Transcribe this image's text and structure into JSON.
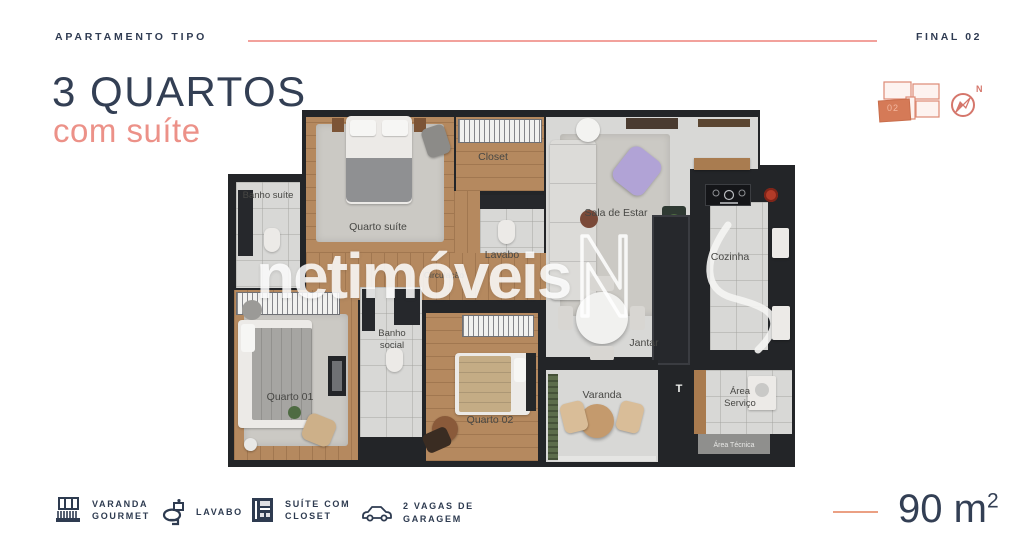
{
  "header": {
    "eyebrow": "APARTAMENTO TIPO",
    "final_label": "FINAL 02",
    "title": "3 QUARTOS",
    "subtitle": "com suíte"
  },
  "keyplan": {
    "unit_number": "02",
    "compass_label": "N"
  },
  "floorplan": {
    "rooms": {
      "banho_suite": "Banho suíte",
      "quarto_suite": "Quarto suíte",
      "closet": "Closet",
      "lavabo": "Lavabo",
      "circulacao": "Circulação",
      "sala_de_estar": "Sala de Estar",
      "cozinha": "Cozinha",
      "quarto_01": "Quarto 01",
      "banho_social": "Banho social",
      "quarto_02": "Quarto 02",
      "jantar": "Jantar",
      "varanda": "Varanda",
      "area_servico": "Área Serviço",
      "area_tecnica": "Área Técnica"
    },
    "tanque_symbol": "T"
  },
  "watermark": {
    "text": "netimóveis"
  },
  "legend": {
    "items": [
      {
        "icon": "balcony-icon",
        "lines": [
          "VARANDA",
          "GOURMET"
        ]
      },
      {
        "icon": "toilet-icon",
        "lines": [
          "LAVABO"
        ]
      },
      {
        "icon": "closet-icon",
        "lines": [
          "SUÍTE COM",
          "CLOSET"
        ]
      },
      {
        "icon": "car-icon",
        "lines": [
          "2 VAGAS DE",
          "GARAGEM"
        ]
      }
    ]
  },
  "area": {
    "value": "90 m",
    "exp": "2"
  },
  "colors": {
    "navy": "#2f3b52",
    "salmon": "#ec9188",
    "line_pink": "#f2a19c",
    "keyplan_fill": "#d57a57",
    "wall": "#232528",
    "wood": "#b5895f",
    "tile": "#d8d8d6"
  }
}
